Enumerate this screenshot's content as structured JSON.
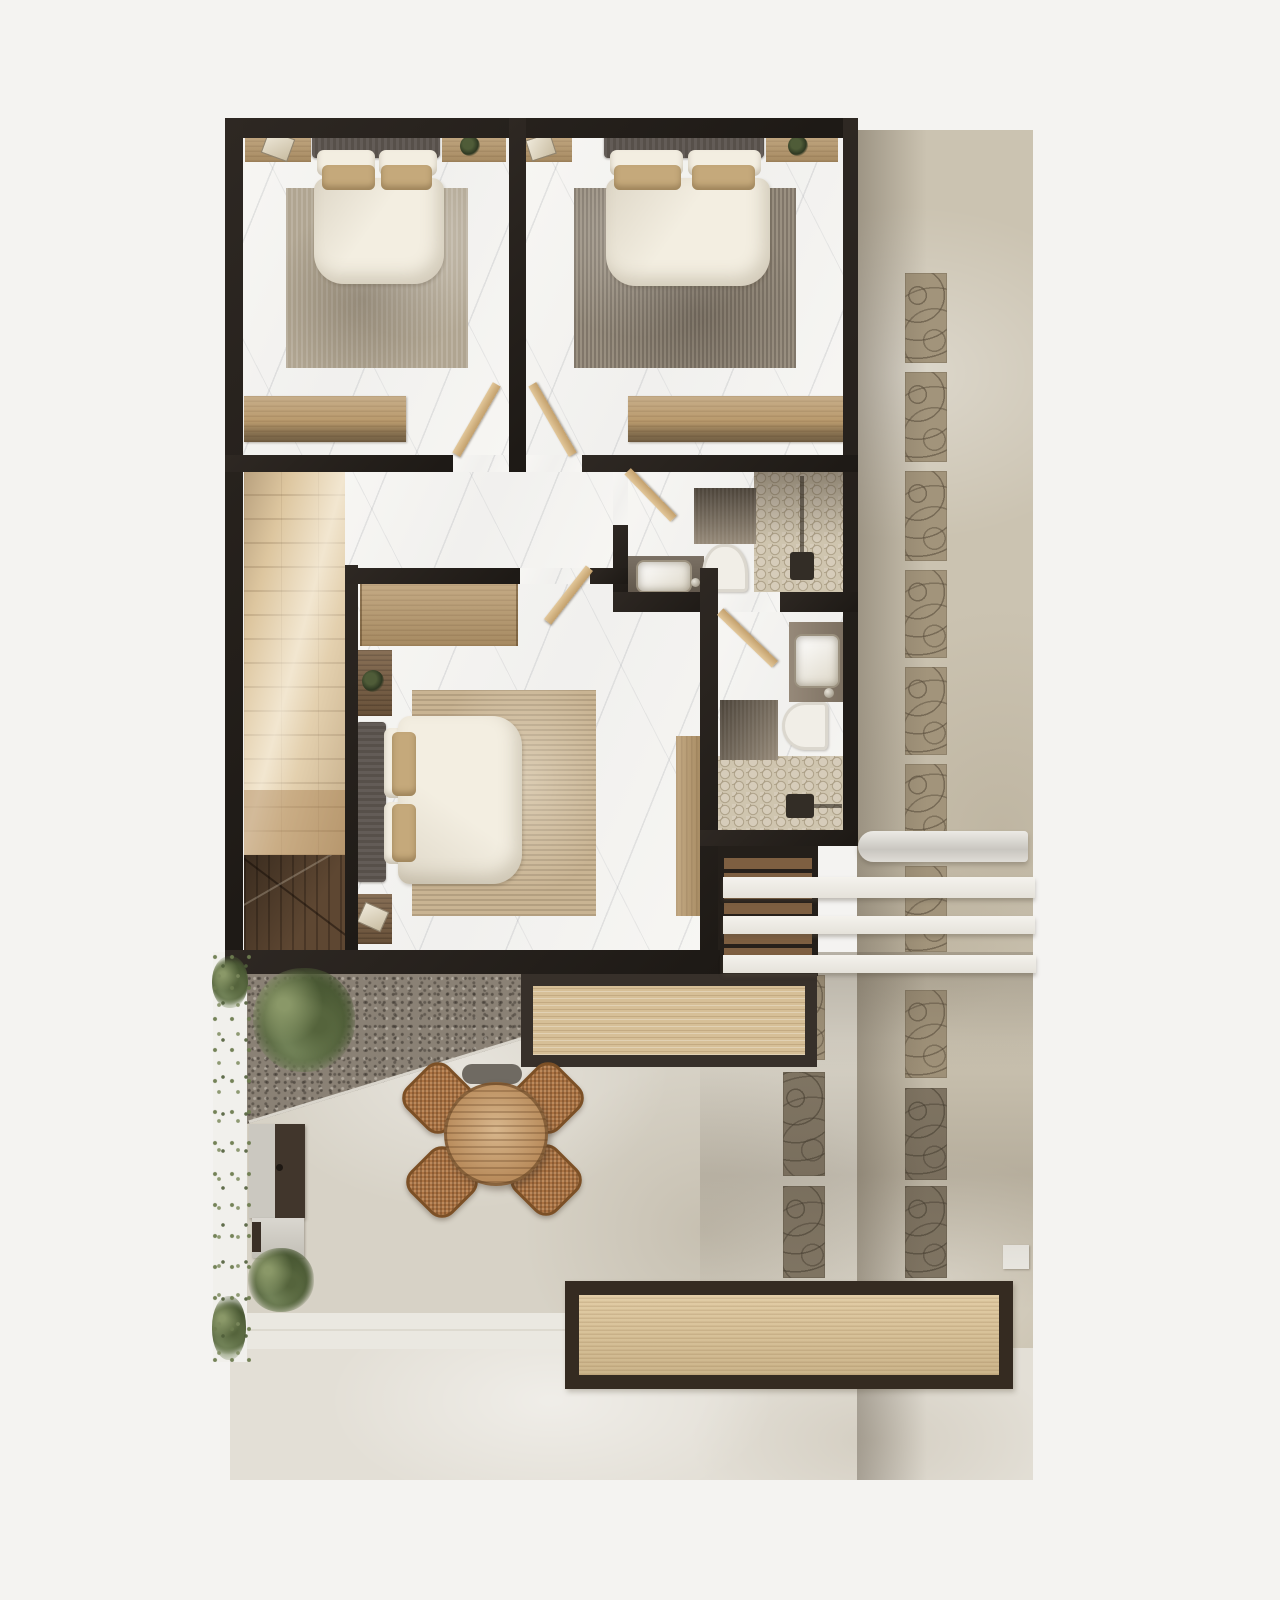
{
  "scene": {
    "type": "architectural floor plan, top-down 3D render",
    "floor": "upper floor with three bedrooms, two bathrooms, stair void, rear terrace and side courtyard",
    "rooms": [
      {
        "name": "bedroom-1",
        "features": [
          "double-bed",
          "two-nightstands",
          "area-rug",
          "dresser",
          "swing-door"
        ]
      },
      {
        "name": "bedroom-2",
        "features": [
          "double-bed",
          "two-nightstands",
          "area-rug",
          "dresser",
          "swing-door"
        ]
      },
      {
        "name": "bedroom-3",
        "features": [
          "double-bed",
          "two-nightstands",
          "area-rug",
          "wardrobe",
          "desk-console",
          "swing-door"
        ]
      },
      {
        "name": "bathroom-1",
        "features": [
          "vanity-sink",
          "toilet",
          "walk-in-shower-penny-tile",
          "bath-mat",
          "swing-door"
        ]
      },
      {
        "name": "bathroom-2",
        "features": [
          "vanity-sink",
          "toilet",
          "penny-tile-shower-floor",
          "bath-mat",
          "swing-door"
        ]
      },
      {
        "name": "hallway",
        "features": [
          "marble-floor"
        ]
      },
      {
        "name": "stair-void",
        "features": [
          "wood-floor",
          "sloped-roof-edge"
        ]
      },
      {
        "name": "exterior",
        "features": [
          "outdoor-stairs",
          "pergola-beams",
          "rolled-awning",
          "deck-table",
          "round-dining-table",
          "four-rattan-chairs",
          "bbq-grill",
          "shrubs",
          "vine-planting-strip",
          "paver-path",
          "gravel-slope",
          "long-planter-bench",
          "walkway"
        ]
      }
    ]
  },
  "colors": {
    "page": "#f4f3f1",
    "wall": "#26211c",
    "marble": "#f7f6f3",
    "wood": "#b99a6d",
    "wood_dark": "#7a5f43",
    "floor_wood": "#ddc69f",
    "roof_wood": "#5e4732",
    "headboard": "#57504a",
    "pillow_beige": "#c5a97b",
    "linen": "#f3eee1",
    "fixture": "#f1eee7",
    "rug1": "#b0a591",
    "rug2": "#9a9081",
    "rug3": "#c9b493",
    "counter": "#6f6457",
    "counter2": "#8d7f6e",
    "hex": "#d6ccba",
    "hex_line": "#a3967c",
    "concrete": "#cbc3b1",
    "concrete2": "#d7d2c6",
    "concrete_light": "#e3dfd6",
    "gravel": "#8a8175",
    "paver": "#a2947b",
    "beam": "#efece6",
    "awning": "#d7d4cf",
    "rattan": "#aa7242",
    "table_wood": "#b98c5c",
    "deck_wood": "#d6bf97",
    "green": "#6d7c4f",
    "walkway": "#eae8e1"
  },
  "outdoor": {
    "paver_columns": [
      {
        "x": 905,
        "w": 42,
        "segments": [
          [
            273,
            90
          ],
          [
            372,
            90
          ],
          [
            471,
            90
          ],
          [
            570,
            88
          ],
          [
            667,
            88
          ],
          [
            764,
            84
          ],
          [
            866,
            86
          ],
          [
            990,
            88
          ],
          [
            1088,
            92
          ],
          [
            1186,
            92
          ]
        ]
      },
      {
        "x": 783,
        "w": 42,
        "segments": [
          [
            975,
            85
          ],
          [
            1072,
            104
          ],
          [
            1186,
            92
          ]
        ]
      }
    ],
    "pergola_beams": [
      [
        723,
        877,
        312,
        21
      ],
      [
        723,
        916,
        312,
        18
      ],
      [
        723,
        955,
        313,
        18
      ]
    ]
  }
}
